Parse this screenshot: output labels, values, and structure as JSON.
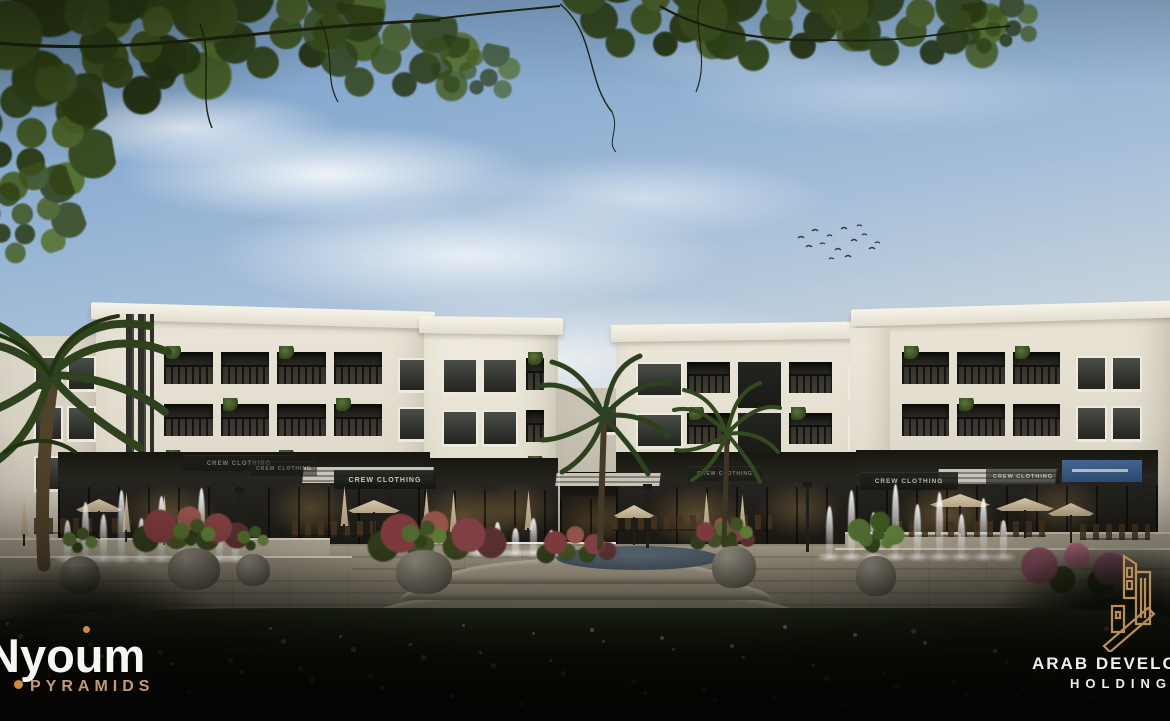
{
  "branding": {
    "project": {
      "name": "Nyoum",
      "subtitle": "PYRAMIDS",
      "name_color": "#f8f6f1",
      "subtitle_color": "#c49a72",
      "accent_color": "#cf8a3c"
    },
    "developer": {
      "line1": "ARAB DEVELOPERS",
      "line2": "HOLDING",
      "text_color": "#f2efe9",
      "mark_color": "#b98f57"
    }
  },
  "signs": [
    {
      "label": "CREW CLOTHING",
      "x": 183,
      "y": 455,
      "w": 112,
      "h": 15,
      "fs": 6,
      "op": 0.55
    },
    {
      "label": "CREW CLOTHING",
      "x": 251,
      "y": 461,
      "w": 66,
      "h": 14,
      "fs": 5,
      "op": 0.5
    },
    {
      "label": "CREW CLOTHING",
      "x": 334,
      "y": 470,
      "w": 102,
      "h": 18,
      "fs": 7,
      "op": 0.95
    },
    {
      "label": "CREW CLOTHING",
      "x": 688,
      "y": 466,
      "w": 74,
      "h": 14,
      "fs": 5,
      "op": 0.55
    },
    {
      "label": "CREW CLOTHING",
      "x": 860,
      "y": 472,
      "w": 98,
      "h": 17,
      "fs": 6.5,
      "op": 0.9
    },
    {
      "label": "CREW CLOTHING",
      "x": 986,
      "y": 468,
      "w": 74,
      "h": 15,
      "fs": 5.5,
      "op": 0.65
    }
  ],
  "blue_sign": {
    "label": "",
    "x": 1062,
    "y": 460,
    "w": 80,
    "h": 22,
    "color": "#4a74a8"
  },
  "palette": {
    "sky_top": "#7aa0c9",
    "sky_horizon": "#e6e6e0",
    "facade": "#e9e4d7",
    "storefront": "#221f19",
    "stone": "#8d8675",
    "lawn": "#121709",
    "gold": "#b98f57"
  },
  "scene": {
    "buildings": [
      {
        "id": "wing-left",
        "x": 0,
        "y": 336,
        "w": 104,
        "h": 206,
        "bg": "linear-gradient(#ded9cc,#cfc9bb)",
        "grids": [
          {
            "x": 30,
            "y": 14,
            "w": 66,
            "h": 150,
            "rows": 3,
            "cols": 2,
            "kind": "window"
          }
        ]
      },
      {
        "id": "block-a",
        "x": 96,
        "y": 320,
        "w": 334,
        "h": 222,
        "bg": "linear-gradient(#eae5d8,#d9d3c4)",
        "cornice": 1.6,
        "fins": {
          "x": 30,
          "w": 28,
          "h": 150
        },
        "grids": [
          {
            "x": 64,
            "y": 26,
            "w": 226,
            "h": 156,
            "rows": 3,
            "cols": 4,
            "kind": "balcony"
          },
          {
            "x": 298,
            "y": 32,
            "w": 32,
            "h": 146,
            "rows": 3,
            "cols": 1,
            "kind": "window"
          }
        ]
      },
      {
        "id": "block-b",
        "x": 424,
        "y": 330,
        "w": 134,
        "h": 212,
        "bg": "linear-gradient(#f0ecdf,#ddd7c8)",
        "cornice": 0.8,
        "grids": [
          {
            "x": 14,
            "y": 22,
            "w": 80,
            "h": 156,
            "rows": 3,
            "cols": 2,
            "kind": "window"
          },
          {
            "x": 98,
            "y": 22,
            "w": 26,
            "h": 156,
            "rows": 3,
            "cols": 1,
            "kind": "balcony"
          }
        ]
      },
      {
        "id": "center-block",
        "x": 556,
        "y": 388,
        "w": 112,
        "h": 154,
        "bg": "linear-gradient(#cdc7ba,#b8b2a4)",
        "grids": [
          {
            "x": 40,
            "y": 12,
            "w": 26,
            "h": 40,
            "rows": 1,
            "cols": 1,
            "kind": "window"
          }
        ]
      },
      {
        "id": "block-c",
        "x": 616,
        "y": 336,
        "w": 270,
        "h": 206,
        "bg": "linear-gradient(#ece7da,#dbd5c6)",
        "cornice": -0.8,
        "grids": [
          {
            "x": 16,
            "y": 20,
            "w": 204,
            "h": 152,
            "rows": 3,
            "cols": 4,
            "kind": "mix"
          },
          {
            "x": 228,
            "y": 24,
            "w": 28,
            "h": 146,
            "rows": 3,
            "cols": 1,
            "kind": "window"
          }
        ]
      },
      {
        "id": "block-d",
        "x": 856,
        "y": 318,
        "w": 314,
        "h": 224,
        "bg": "linear-gradient(#e9e4d6,#d8d2c3)",
        "cornice": -1.6,
        "grids": [
          {
            "x": 42,
            "y": 28,
            "w": 166,
            "h": 156,
            "rows": 3,
            "cols": 3,
            "kind": "balcony"
          },
          {
            "x": 216,
            "y": 32,
            "w": 70,
            "h": 150,
            "rows": 3,
            "cols": 2,
            "kind": "window"
          }
        ]
      },
      {
        "id": "pier-cd",
        "x": 850,
        "y": 328,
        "w": 40,
        "h": 214,
        "bg": "linear-gradient(#f3efe3,#e2dccd)",
        "grids": []
      }
    ],
    "shops": [
      {
        "x": 58,
        "y": 452,
        "w": 372,
        "h": 92
      },
      {
        "x": 424,
        "y": 458,
        "w": 134,
        "h": 84
      },
      {
        "x": 560,
        "y": 472,
        "w": 102,
        "h": 70,
        "dim": true
      },
      {
        "x": 616,
        "y": 452,
        "w": 270,
        "h": 92
      },
      {
        "x": 856,
        "y": 450,
        "w": 302,
        "h": 94
      }
    ],
    "awnings": [
      {
        "x": 303,
        "y": 467,
        "w": 130,
        "h": 16
      },
      {
        "x": 938,
        "y": 469,
        "w": 118,
        "h": 15
      },
      {
        "x": 556,
        "y": 473,
        "w": 104,
        "h": 13
      }
    ],
    "poles": [
      {
        "x": 388,
        "y": 486,
        "h": 64
      },
      {
        "x": 646,
        "y": 488,
        "h": 60
      },
      {
        "x": 806,
        "y": 486,
        "h": 66
      },
      {
        "x": 238,
        "y": 492,
        "h": 54
      }
    ],
    "umbrellas_closed": [
      [
        120,
        492
      ],
      [
        158,
        495
      ],
      [
        338,
        486
      ],
      [
        420,
        489
      ],
      [
        447,
        492
      ],
      [
        522,
        490
      ],
      [
        700,
        492
      ],
      [
        736,
        494
      ],
      [
        18,
        496
      ]
    ],
    "umbrellas_open": [
      [
        348,
        500,
        52
      ],
      [
        930,
        494,
        60
      ],
      [
        996,
        498,
        58
      ],
      [
        1048,
        503,
        46
      ],
      [
        76,
        499,
        46
      ],
      [
        614,
        505,
        40
      ]
    ],
    "chair_rows": [
      [
        34,
        518,
        120
      ],
      [
        292,
        521,
        176
      ],
      [
        612,
        515,
        160
      ],
      [
        896,
        521,
        150
      ],
      [
        1080,
        524,
        70
      ]
    ],
    "walls": [
      {
        "x": 0,
        "y": 538,
        "w": 330,
        "h": 20,
        "c": "#a59d8b"
      },
      {
        "x": 0,
        "y": 556,
        "w": 352,
        "h": 12,
        "c": "#8f8776"
      },
      {
        "x": 845,
        "y": 532,
        "w": 325,
        "h": 18,
        "c": "#a8a08e"
      },
      {
        "x": 835,
        "y": 548,
        "w": 335,
        "h": 12,
        "c": "#938b79"
      }
    ],
    "steps": [
      {
        "x": 362,
        "y": 588,
        "w": 448,
        "h": 34,
        "c": "#87806e"
      },
      {
        "x": 400,
        "y": 572,
        "w": 372,
        "h": 28,
        "c": "#938b78"
      },
      {
        "x": 436,
        "y": 558,
        "w": 300,
        "h": 26,
        "c": "#9e9583"
      }
    ],
    "water_pool": {
      "x": 556,
      "y": 546,
      "w": 164,
      "h": 24,
      "c": "#3e4b55"
    },
    "fountains": [
      {
        "base": 560,
        "jets": [
          [
            64,
            40
          ],
          [
            82,
            58
          ],
          [
            100,
            46
          ],
          [
            118,
            70
          ],
          [
            138,
            42
          ],
          [
            158,
            64
          ],
          [
            178,
            50
          ],
          [
            198,
            72
          ],
          [
            216,
            46
          ],
          [
            232,
            34
          ]
        ]
      },
      {
        "base": 554,
        "jets": [
          [
            476,
            24
          ],
          [
            494,
            32
          ],
          [
            512,
            26
          ],
          [
            530,
            36
          ],
          [
            548,
            24
          ]
        ]
      },
      {
        "base": 558,
        "jets": [
          [
            826,
            52
          ],
          [
            848,
            68
          ],
          [
            870,
            46
          ],
          [
            892,
            74
          ],
          [
            914,
            54
          ],
          [
            936,
            66
          ],
          [
            958,
            44
          ],
          [
            980,
            60
          ],
          [
            1000,
            38
          ]
        ]
      }
    ],
    "pots": [
      {
        "x": 168,
        "y": 548,
        "w": 52,
        "h": 42
      },
      {
        "x": 396,
        "y": 550,
        "w": 56,
        "h": 44
      },
      {
        "x": 712,
        "y": 546,
        "w": 44,
        "h": 42
      },
      {
        "x": 856,
        "y": 556,
        "w": 40,
        "h": 40
      },
      {
        "x": 236,
        "y": 554,
        "w": 34,
        "h": 32
      },
      {
        "x": 60,
        "y": 556,
        "w": 40,
        "h": 38
      }
    ],
    "red_shrubs": [
      {
        "x": 128,
        "y": 502,
        "w": 128,
        "h": 54
      },
      {
        "x": 362,
        "y": 508,
        "w": 152,
        "h": 56
      },
      {
        "x": 534,
        "y": 520,
        "w": 86,
        "h": 50
      },
      {
        "x": 688,
        "y": 512,
        "w": 70,
        "h": 44
      }
    ],
    "pink_bush": {
      "x": 1002,
      "y": 536,
      "w": 150,
      "h": 66
    },
    "tall_green": {
      "x": 834,
      "y": 506,
      "w": 84,
      "h": 60
    },
    "foliage": [
      {
        "x": -20,
        "y": -30,
        "w": 260,
        "h": 170,
        "r": -8,
        "op": 1
      },
      {
        "x": 60,
        "y": -10,
        "w": 180,
        "h": 110,
        "r": 10,
        "op": 0.95
      },
      {
        "x": 190,
        "y": -20,
        "w": 200,
        "h": 100,
        "r": -5,
        "op": 0.95
      },
      {
        "x": 300,
        "y": 10,
        "w": 180,
        "h": 95,
        "r": 8,
        "op": 0.85
      },
      {
        "x": -30,
        "y": 60,
        "w": 130,
        "h": 150,
        "r": 80,
        "op": 0.95
      },
      {
        "x": -20,
        "y": 160,
        "w": 90,
        "h": 110,
        "r": 70,
        "op": 0.85
      },
      {
        "x": 560,
        "y": -30,
        "w": 180,
        "h": 95,
        "r": 6,
        "op": 0.95
      },
      {
        "x": 680,
        "y": -20,
        "w": 200,
        "h": 90,
        "r": -7,
        "op": 0.95
      },
      {
        "x": 820,
        "y": -10,
        "w": 190,
        "h": 80,
        "r": 5,
        "op": 0.9
      },
      {
        "x": 950,
        "y": 0,
        "w": 90,
        "h": 55,
        "r": -8,
        "op": 0.8
      },
      {
        "x": 420,
        "y": 40,
        "w": 100,
        "h": 60,
        "r": 12,
        "op": 0.7
      }
    ],
    "flower_colors": [
      "#9b93b5",
      "#b9b2cc",
      "#7f7899"
    ],
    "flower_count": 64
  }
}
